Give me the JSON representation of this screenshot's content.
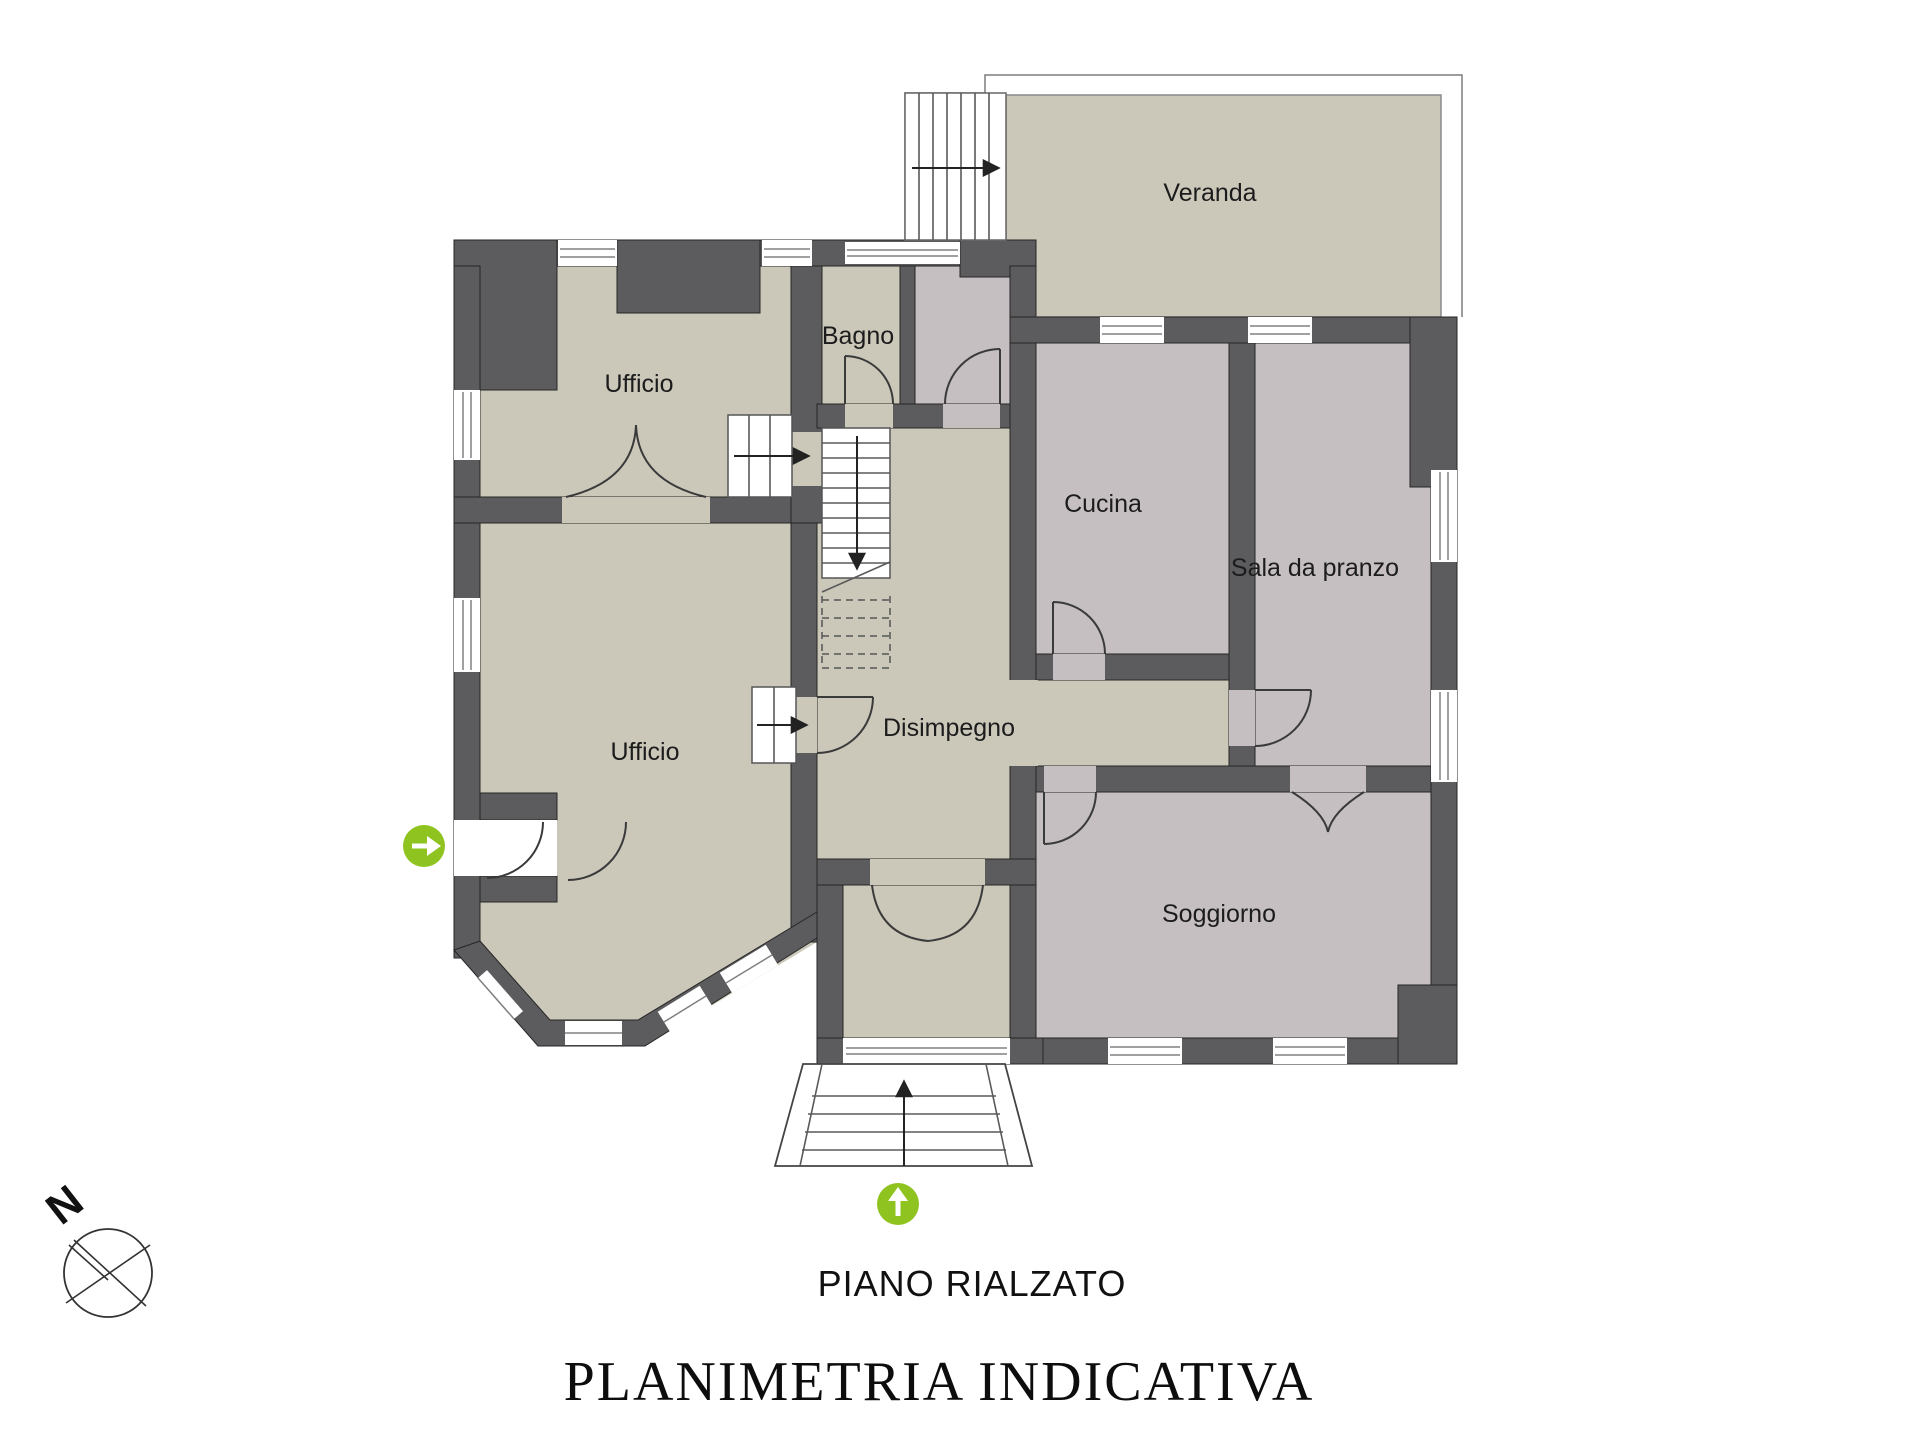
{
  "plan": {
    "floor_label": "PIANO RIALZATO",
    "document_title": "PLANIMETRIA INDICATIVA",
    "compass_label": "N",
    "rooms": {
      "veranda": "Veranda",
      "bagno": "Bagno",
      "ufficio_nord": "Ufficio",
      "cucina": "Cucina",
      "sala_da_pranzo": "Sala da pranzo",
      "disimpegno": "Disimpegno",
      "ufficio_sud": "Ufficio",
      "soggiorno": "Soggiorno"
    },
    "icons": {
      "side_entrance": "green-circle-arrow-right",
      "front_entrance": "green-circle-arrow-up",
      "compass": "compass-rose-north"
    },
    "colors": {
      "wall": "#5C5C5E",
      "floor_beige": "#CBC8BA",
      "floor_mauve": "#C5BFC1",
      "accent_green": "#8FC31F",
      "background": "#FFFFFF"
    }
  }
}
